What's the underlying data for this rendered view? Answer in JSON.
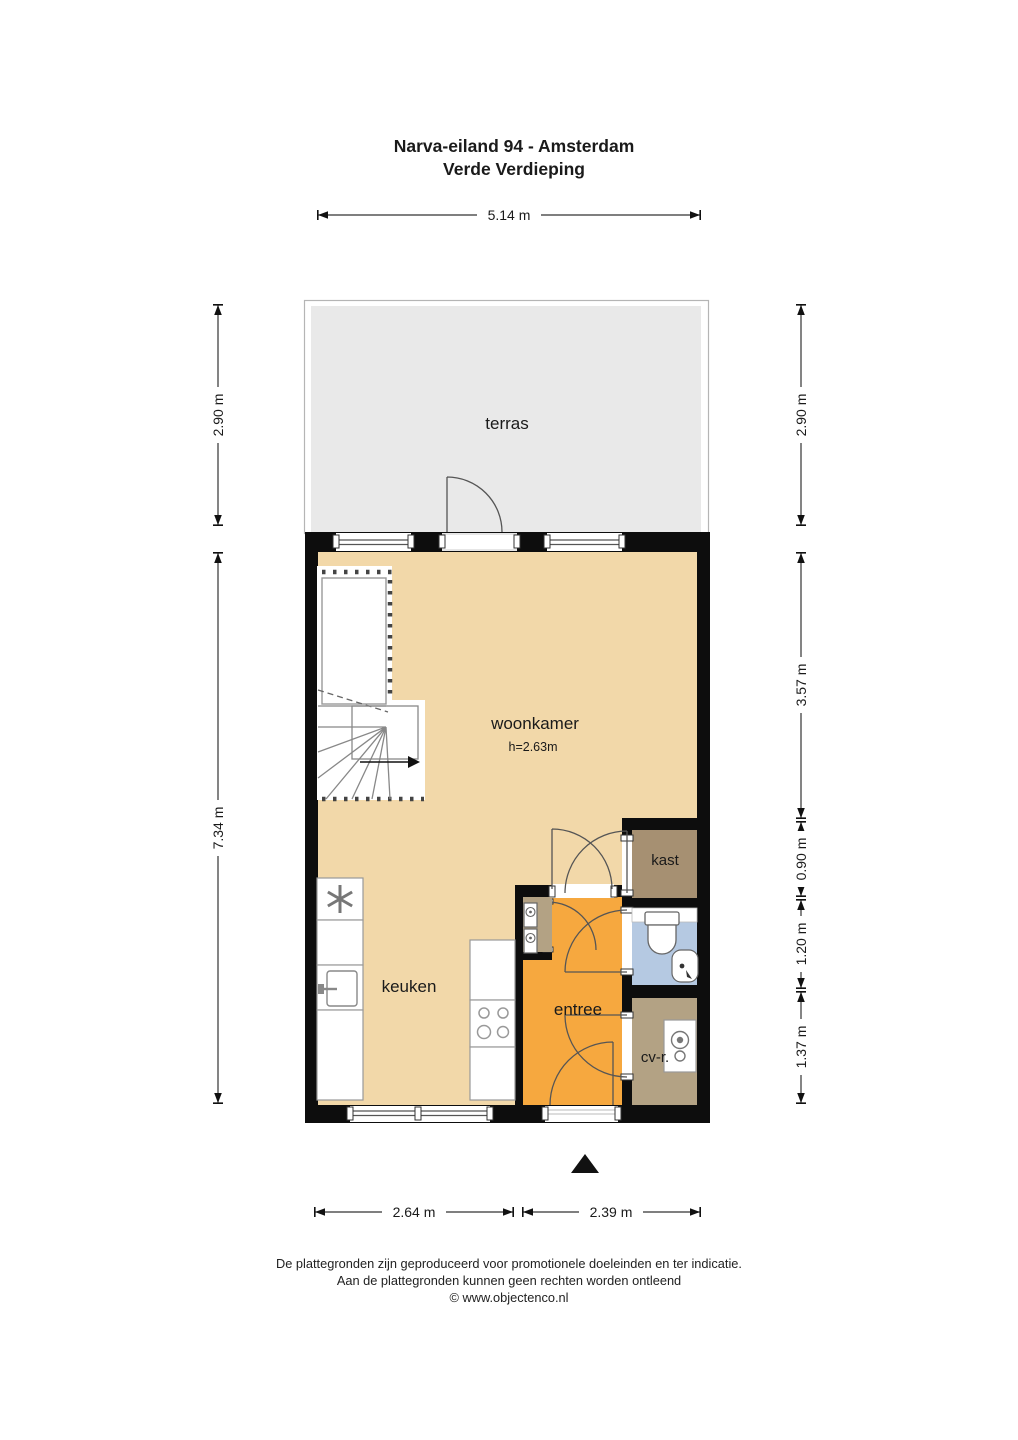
{
  "title": {
    "line1": "Narva-eiland 94 - Amsterdam",
    "line2": "Verde Verdieping"
  },
  "rooms": {
    "terras": "terras",
    "woonkamer": "woonkamer",
    "woonkamer_height": "h=2.63m",
    "keuken": "keuken",
    "entree": "entree",
    "kast": "kast",
    "cv": "cv-r."
  },
  "dimensions": {
    "top": "5.14 m",
    "left_top": "2.90 m",
    "left_bottom": "7.34 m",
    "right_1": "2.90 m",
    "right_2": "3.57 m",
    "right_3": "0.90 m",
    "right_4": "1.20 m",
    "right_5": "1.37 m",
    "bottom_left": "2.64 m",
    "bottom_right": "2.39 m"
  },
  "footer": {
    "line1": "De plattegronden zijn geproduceerd voor promotionele doeleinden en ter indicatie.",
    "line2": "Aan de plattegronden kunnen geen rechten worden ontleend",
    "line3": "© www.objectenco.nl"
  },
  "colors": {
    "floor": "#f2d8a9",
    "terras": "#e9e9e9",
    "entree": "#f6a83f",
    "kast": "#a69072",
    "cv": "#b3a284",
    "bath": "#b5c9e2",
    "wall": "#0d0d0d"
  }
}
